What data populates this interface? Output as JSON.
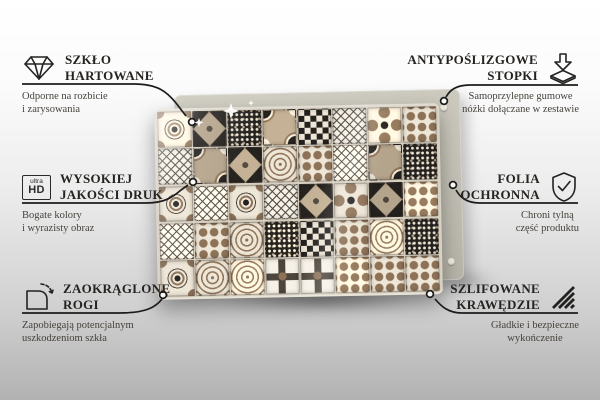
{
  "colors": {
    "connector_line": "#1d1c1a",
    "title_text": "#262421",
    "subtitle_text": "#46423c",
    "backing_board": "#c8c6ba",
    "grout": "#d6cfc0"
  },
  "product": {
    "description": "glass board printed with vintage patchwork ceramic tile pattern, back board with anti-slip feet behind it",
    "grid": {
      "rows": 5,
      "cols": 8
    },
    "palette": {
      "black": "#24211e",
      "dark": "#4e463d",
      "brown": "#8d7257",
      "taupe": "#b5a48c",
      "cream": "#eee6d6",
      "white": "#f7f2e8"
    }
  },
  "callouts": {
    "left": [
      {
        "id": "tempered-glass",
        "icon": "diamond-icon",
        "title_lines": [
          "SZKŁO",
          "HARTOWANE"
        ],
        "subtitle_lines": [
          "Odporne na rozbicie",
          "i zarysowania"
        ]
      },
      {
        "id": "hd-print",
        "icon": "ultra-hd-icon",
        "icon_label_top": "ultra",
        "icon_label_bottom": "HD",
        "title_lines": [
          "WYSOKIEJ",
          "JAKOŚCI DRUK"
        ],
        "subtitle_lines": [
          "Bogate kolory",
          "i wyrazisty obraz"
        ]
      },
      {
        "id": "rounded-corners",
        "icon": "rounded-corner-icon",
        "title_lines": [
          "ZAOKRĄGLONE",
          "ROGI"
        ],
        "subtitle_lines": [
          "Zapobiegają potencjalnym",
          "uszkodzeniom szkła"
        ]
      }
    ],
    "right": [
      {
        "id": "anti-slip-feet",
        "icon": "anti-slip-feet-icon",
        "title_lines": [
          "ANTYPOŚLIZGOWE",
          "STOPKI"
        ],
        "subtitle_lines": [
          "Samoprzylepne gumowe",
          "nóżki dołączane w zestawie"
        ]
      },
      {
        "id": "protective-film",
        "icon": "shield-check-icon",
        "title_lines": [
          "FOLIA",
          "OCHRONNA"
        ],
        "subtitle_lines": [
          "Chroni tylną",
          "część produktu"
        ]
      },
      {
        "id": "polished-edges",
        "icon": "polished-edges-icon",
        "title_lines": [
          "SZLIFOWANE",
          "KRAWĘDZIE"
        ],
        "subtitle_lines": [
          "Gładkie i bezpieczne",
          "wykończenie"
        ]
      }
    ]
  }
}
